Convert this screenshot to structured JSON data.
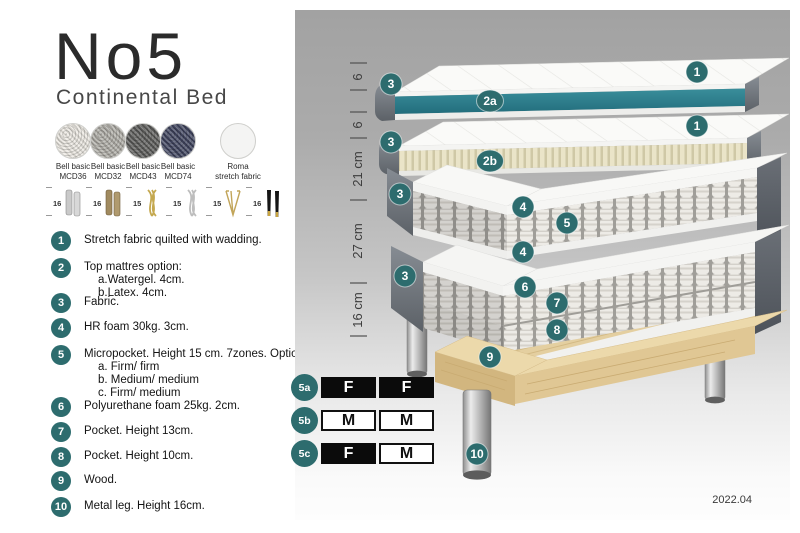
{
  "header": {
    "title": "No5",
    "subtitle": "Continental Bed"
  },
  "swatches": [
    {
      "line1": "Bell basic",
      "line2": "MCD36",
      "color": "#ece9e2"
    },
    {
      "line1": "Bell basic",
      "line2": "MCD32",
      "color": "#b1afa9"
    },
    {
      "line1": "Bell basic",
      "line2": "MCD43",
      "color": "#5e5e5c"
    },
    {
      "line1": "Bell basic",
      "line2": "MCD74",
      "color": "#414660"
    },
    {
      "line1": "Roma",
      "line2": "stretch fabric",
      "color": "#f4f4f3"
    }
  ],
  "legs": [
    {
      "height": "16",
      "type": "cylinder-silver"
    },
    {
      "height": "16",
      "type": "cylinder-bronze"
    },
    {
      "height": "15",
      "type": "twist-gold"
    },
    {
      "height": "15",
      "type": "twist-silver"
    },
    {
      "height": "15",
      "type": "hairpin-gold"
    },
    {
      "height": "16",
      "type": "tapered-black-gold"
    }
  ],
  "features": [
    {
      "num": "1",
      "text": "Stretch fabric quilted with wadding."
    },
    {
      "num": "2",
      "text": "Top mattres option:",
      "subs": [
        "a.Watergel. 4cm.",
        "b.Latex. 4cm."
      ]
    },
    {
      "num": "3",
      "text": "Fabric."
    },
    {
      "num": "4",
      "text": "HR foam 30kg. 3cm."
    },
    {
      "num": "5",
      "text": "Micropocket. Height 15 cm. 7zones. Option:",
      "subs": [
        "a. Firm/ firm",
        "b. Medium/ medium",
        "c. Firm/ medium"
      ]
    },
    {
      "num": "6",
      "text": "Polyurethane foam 25kg. 2cm."
    },
    {
      "num": "7",
      "text": "Pocket. Height 13cm."
    },
    {
      "num": "8",
      "text": "Pocket. Height 10cm."
    },
    {
      "num": "9",
      "text": "Wood."
    },
    {
      "num": "10",
      "text": "Metal leg. Height 16cm."
    }
  ],
  "diagram": {
    "dimensions": [
      "6",
      "6",
      "21 cm",
      "27 cm",
      "16 cm"
    ],
    "callouts": {
      "c1": "1",
      "c2a": "2a",
      "c2b": "2b",
      "c3": "3",
      "c4": "4",
      "c5": "5",
      "c6": "6",
      "c7": "7",
      "c8": "8",
      "c9": "9",
      "c10": "10"
    },
    "footer": "2022.04"
  },
  "firmness": {
    "rows": [
      {
        "id": "5a",
        "cells": [
          {
            "letter": "F",
            "variant": "filled"
          },
          {
            "letter": "F",
            "variant": "filled"
          }
        ]
      },
      {
        "id": "5b",
        "cells": [
          {
            "letter": "M",
            "variant": "outline"
          },
          {
            "letter": "M",
            "variant": "outline"
          }
        ]
      },
      {
        "id": "5c",
        "cells": [
          {
            "letter": "F",
            "variant": "filled"
          },
          {
            "letter": "M",
            "variant": "outline"
          }
        ]
      }
    ]
  },
  "colors": {
    "accent_teal": "#2d6c6e",
    "core_teal": "#2f7f8c",
    "fabric_grey": "#70767d",
    "latex_cream": "#e9e3c6",
    "wood": "#e3cda0"
  }
}
